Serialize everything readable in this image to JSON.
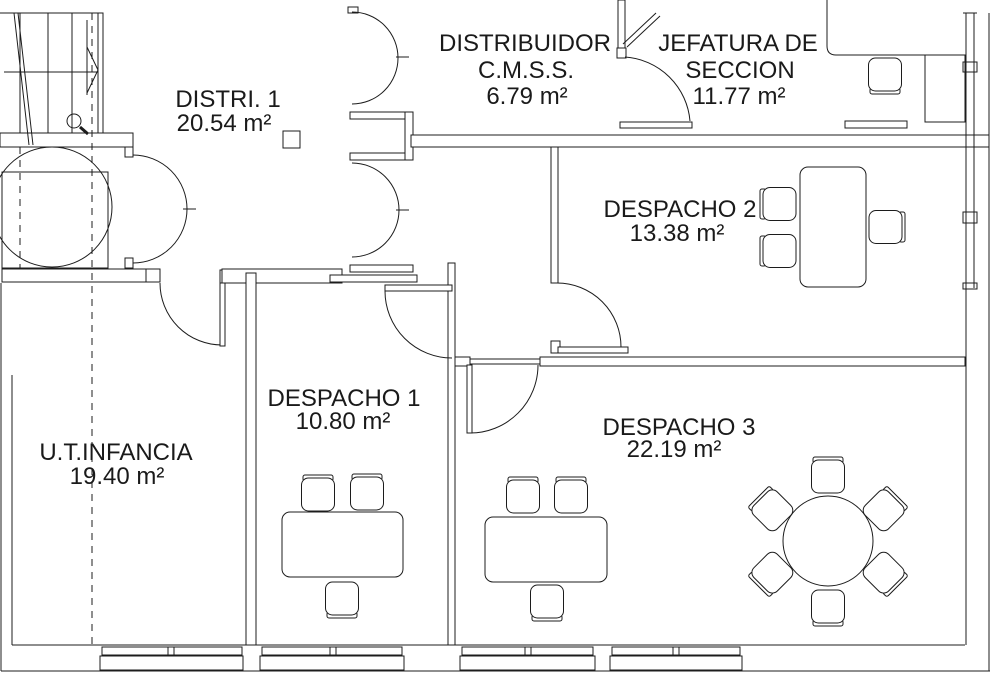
{
  "drawing": {
    "kind": "floor-plan",
    "line_color": "#1c1c1c",
    "background": "#ffffff"
  },
  "rooms": [
    {
      "id": "distri-1",
      "name": "DISTRI. 1",
      "area": "20.54 m²"
    },
    {
      "id": "distribuidor-cmss",
      "name": "DISTRIBUIDOR",
      "subname": "C.M.S.S.",
      "area": "6.79 m²"
    },
    {
      "id": "jefatura-seccion",
      "name": "JEFATURA DE",
      "subname": "SECCION",
      "area": "11.77 m²"
    },
    {
      "id": "despacho-2",
      "name": "DESPACHO 2",
      "area": "13.38 m²"
    },
    {
      "id": "despacho-1",
      "name": "DESPACHO 1",
      "area": "10.80 m²"
    },
    {
      "id": "despacho-3",
      "name": "DESPACHO 3",
      "area": "22.19 m²"
    },
    {
      "id": "ut-infancia",
      "name": "U.T.INFANCIA",
      "area": "19.40 m²"
    }
  ],
  "floorplan": {
    "walls": [
      [
        98,
        13,
        5,
        120,
        "stair-side-wall"
      ],
      [
        0,
        133,
        133,
        14,
        "stair-landing-wall"
      ],
      [
        125,
        147,
        8,
        10,
        "lobby-door-jamb-top"
      ],
      [
        125,
        258,
        8,
        10,
        "lobby-door-jamb-bottom"
      ],
      [
        2,
        269,
        146,
        13,
        "uti-north-wall-west"
      ],
      [
        146,
        269,
        14,
        13,
        "uti-door-jamb-left"
      ],
      [
        220,
        270,
        13,
        13,
        "uti-door-jamb-right"
      ],
      [
        222,
        269,
        120,
        14,
        "despacho1-north-wall"
      ],
      [
        330,
        275,
        87,
        7,
        "despacho1-north-wall-jog"
      ],
      [
        350,
        265,
        63,
        7,
        "distribuidor-south-stub"
      ],
      [
        350,
        112,
        63,
        7,
        "distribuidor-mid-post-top"
      ],
      [
        350,
        153,
        63,
        7,
        "distribuidor-mid-post-bottom"
      ],
      [
        405,
        112,
        8,
        48,
        "distribuidor-mid-post-cap"
      ],
      [
        348,
        7,
        10,
        6,
        "distribuidor-north-jamb"
      ],
      [
        411,
        135,
        578,
        12,
        "corridor-south-wall"
      ],
      [
        551,
        147,
        7,
        136,
        "despacho2-west-wall"
      ],
      [
        551,
        341,
        9,
        12,
        "despacho2-door-jamb"
      ],
      [
        455,
        357,
        15,
        9,
        "despacho23-divider-west"
      ],
      [
        540,
        357,
        425,
        9,
        "despacho23-divider"
      ],
      [
        448,
        263,
        7,
        382,
        "despacho1-east-wall"
      ],
      [
        246,
        273,
        10,
        372,
        "uti-east-wall"
      ],
      [
        618,
        0,
        7,
        48,
        "jefatura-west-wall"
      ],
      [
        617,
        48,
        9,
        10,
        "jefatura-door-jamb"
      ],
      [
        620,
        122,
        72,
        6,
        "jefatura-door-head"
      ],
      [
        845,
        121,
        62,
        7,
        "jefatura-counter"
      ],
      [
        963,
        62,
        14,
        10,
        "east-window-mullion-1"
      ],
      [
        963,
        212,
        14,
        11,
        "east-window-mullion-2"
      ],
      [
        963,
        283,
        14,
        6,
        "east-window-mullion-3"
      ],
      [
        102,
        647,
        140,
        8,
        "window-uti-frame"
      ],
      [
        168,
        647,
        6,
        8,
        "window-uti-mullion"
      ],
      [
        100,
        656,
        143,
        14,
        "window-uti-sill"
      ],
      [
        262,
        647,
        140,
        8,
        "window-d1-frame"
      ],
      [
        330,
        647,
        6,
        8,
        "window-d1-mullion"
      ],
      [
        260,
        656,
        144,
        14,
        "window-d1-sill"
      ],
      [
        462,
        647,
        131,
        8,
        "window-d3a-frame"
      ],
      [
        525,
        647,
        6,
        8,
        "window-d3a-mullion"
      ],
      [
        460,
        656,
        135,
        14,
        "window-d3a-sill"
      ],
      [
        612,
        647,
        128,
        8,
        "window-d3b-frame"
      ],
      [
        673,
        647,
        6,
        8,
        "window-d3b-mullion"
      ],
      [
        610,
        656,
        132,
        14,
        "window-d3b-sill"
      ]
    ],
    "outlines": [
      [
        2,
        172,
        106,
        96,
        "elevator-shaft"
      ],
      [
        925,
        55,
        40,
        67,
        "jefatura-desk-return"
      ]
    ],
    "segments": [
      [
        0,
        13,
        103,
        13,
        "stair-top-edge",
        1
      ],
      [
        20,
        13,
        20,
        133,
        "stair-riser-1",
        1
      ],
      [
        48,
        13,
        48,
        133,
        "stair-riser-2",
        1
      ],
      [
        72,
        13,
        72,
        133,
        "stair-riser-3",
        1
      ],
      [
        4,
        72,
        98,
        72,
        "stair-tread-line",
        1
      ],
      [
        14,
        13,
        29,
        145,
        "stair-break-line-1",
        1
      ],
      [
        18,
        13,
        33,
        145,
        "stair-break-line-2",
        1
      ],
      [
        87,
        20,
        87,
        95,
        "stair-arrow-shaft",
        1
      ],
      [
        87,
        47,
        98,
        70,
        "stair-arrow-head-upper",
        1
      ],
      [
        98,
        70,
        87,
        93,
        "stair-arrow-head-lower",
        1
      ],
      [
        80,
        127,
        88,
        134,
        "key-symbol-handle",
        3
      ],
      [
        12,
        645,
        965,
        645,
        "south-wall-inner",
        1
      ],
      [
        1,
        671,
        990,
        671,
        "south-wall-outer",
        1
      ],
      [
        1,
        283,
        1,
        671,
        "west-wall-outer",
        1
      ],
      [
        12,
        375,
        12,
        645,
        "west-wall-inner",
        1
      ],
      [
        966,
        13,
        966,
        645,
        "east-window-inner",
        1
      ],
      [
        974,
        13,
        974,
        288,
        "east-window-pane",
        1
      ],
      [
        989,
        13,
        989,
        671,
        "east-wall-outer",
        1
      ],
      [
        963,
        13,
        977,
        13,
        "east-window-cap",
        1
      ],
      [
        183,
        209,
        196,
        209,
        "lobby-door-meet-tick",
        1
      ],
      [
        396,
        57,
        409,
        57,
        "distribuidor-door1-tick",
        1
      ],
      [
        396,
        210,
        409,
        210,
        "distribuidor-door2-tick",
        1
      ],
      [
        470,
        359,
        540,
        359,
        "despacho3-threshold-1",
        1
      ],
      [
        470,
        364,
        540,
        364,
        "despacho3-threshold-2",
        1
      ],
      [
        623,
        44,
        656,
        13,
        "jefatura-door-leaf-a",
        1
      ],
      [
        627,
        47,
        660,
        16,
        "jefatura-door-leaf-b",
        1
      ]
    ],
    "arcs": [
      [
        "M133,155 A54,54 0 0 1 187,209",
        "lobby-door-arc-top"
      ],
      [
        "M133,263 A54,54 0 0 0 187,209",
        "lobby-door-arc-bottom"
      ],
      [
        "M352,12 A46,46 0 0 1 398,58",
        "distribuidor-door1-arc-top"
      ],
      [
        "M352,104 A46,46 0 0 0 398,58",
        "distribuidor-door1-arc-bottom"
      ],
      [
        "M352,163 A47,47 0 0 1 399,210",
        "distribuidor-door2-arc-top"
      ],
      [
        "M352,257 A47,47 0 0 0 399,210",
        "distribuidor-door2-arc-bottom"
      ],
      [
        "M160,283 A62,62 0 0 0 222,345",
        "uti-door-arc"
      ],
      [
        "M385,291 A67,67 0 0 0 452,358",
        "despacho1-door-arc"
      ],
      [
        "M557,283 A64,64 0 0 1 621,347",
        "despacho2-door-arc"
      ],
      [
        "M470,433 A68,68 0 0 0 538,365",
        "despacho3-door-arc"
      ],
      [
        "M625,57 A70,70 0 0 1 690,121",
        "jefatura-door-arc"
      ],
      [
        "M827,0 L827,46 Q827,55 836,55 L965,55",
        "jefatura-desk-edge"
      ]
    ],
    "leaves": [
      [
        220,
        283,
        5,
        63,
        "uti-door-leaf"
      ],
      [
        385,
        285,
        67,
        6,
        "despacho1-door-leaf"
      ],
      [
        558,
        347,
        70,
        6,
        "despacho2-door-leaf"
      ],
      [
        467,
        365,
        5,
        68,
        "despacho3-door-leaf"
      ]
    ],
    "dashes": [
      [
        20,
        147,
        20,
        268,
        "elevator-axis-line"
      ],
      [
        92,
        13,
        92,
        644,
        "section-line"
      ]
    ],
    "circles": [
      [
        52,
        207,
        60,
        "elevator-circle",
        "outline"
      ],
      [
        74,
        121,
        7,
        "key-symbol-ring",
        "outline"
      ],
      [
        828,
        541,
        45,
        "meeting-table",
        "furn"
      ]
    ],
    "desks": [
      [
        282,
        512,
        121,
        65,
        8,
        "despacho1-desk"
      ],
      [
        485,
        517,
        122,
        65,
        8,
        "despacho3-desk"
      ],
      [
        800,
        167,
        66,
        120,
        8,
        "despacho2-desk"
      ],
      [
        283,
        131,
        17,
        17,
        0,
        "column"
      ]
    ],
    "chairs": [
      [
        318,
        494,
        0,
        "despacho1-chair-1"
      ],
      [
        367,
        493,
        0,
        "despacho1-chair-2"
      ],
      [
        342,
        599,
        180,
        "despacho1-chair-3"
      ],
      [
        523,
        496,
        0,
        "despacho3-chair-1"
      ],
      [
        571,
        496,
        0,
        "despacho3-chair-2"
      ],
      [
        547,
        602,
        180,
        "despacho3-chair-3"
      ],
      [
        779,
        204,
        270,
        "despacho2-chair-1"
      ],
      [
        779,
        251,
        270,
        "despacho2-chair-2"
      ],
      [
        886,
        227,
        90,
        "despacho2-chair-3"
      ],
      [
        885,
        75,
        180,
        "jefatura-chair"
      ],
      [
        828,
        476,
        0,
        "table-chair-n"
      ],
      [
        828,
        607,
        180,
        "table-chair-s"
      ],
      [
        772,
        510,
        -45,
        "table-chair-nw"
      ],
      [
        884,
        510,
        45,
        "table-chair-ne"
      ],
      [
        772,
        573,
        -135,
        "table-chair-sw"
      ],
      [
        884,
        573,
        135,
        "table-chair-se"
      ]
    ]
  }
}
